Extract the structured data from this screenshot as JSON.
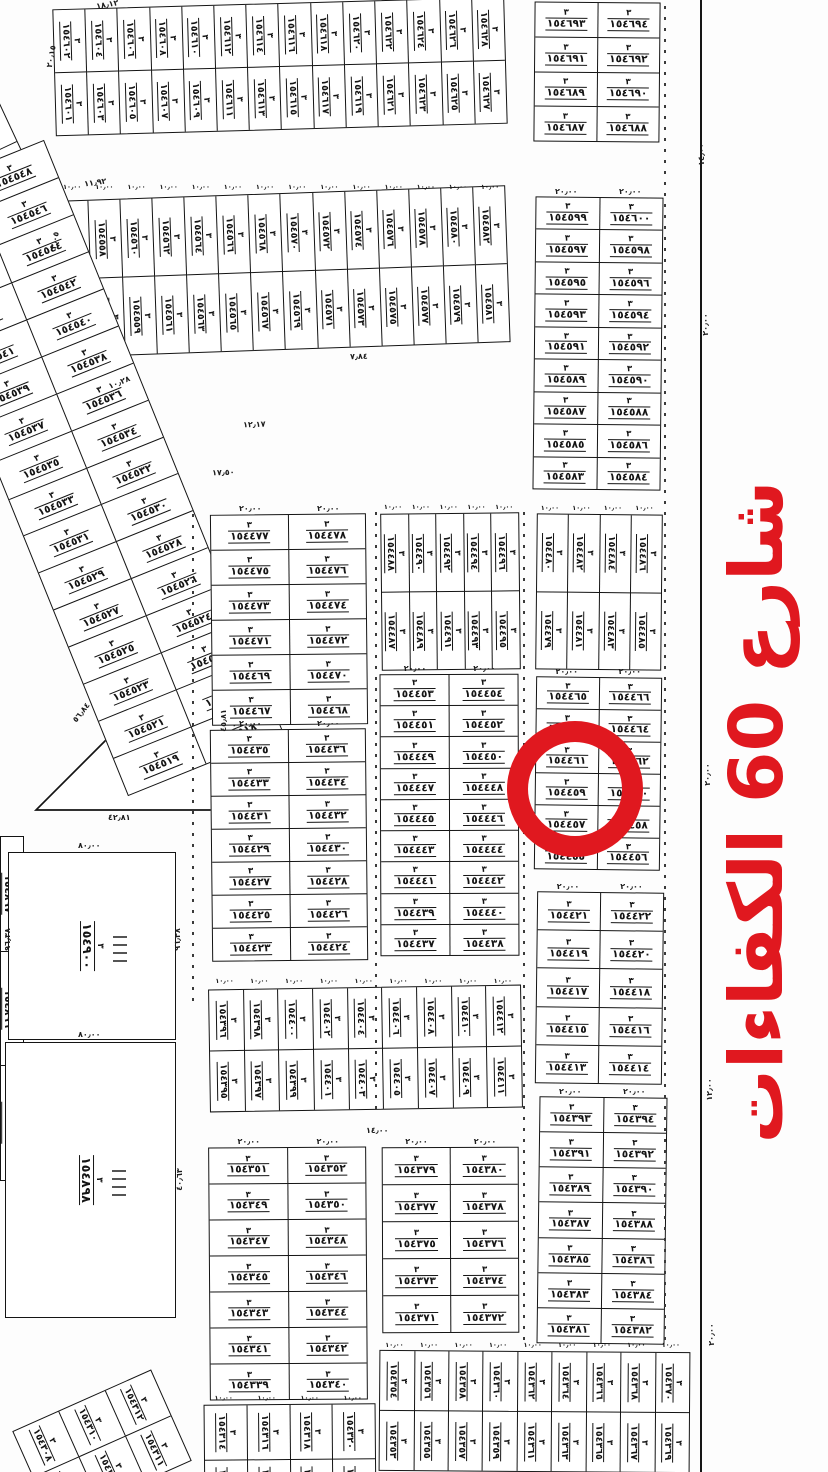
{
  "colors": {
    "red": "#e0181f",
    "ink": "#141414"
  },
  "street_label": {
    "text": "شارع 60 الكفاءات"
  },
  "highlight_circle": {
    "plot": "١٥٤٤٦٠"
  },
  "block_no": "٣",
  "triangle": {
    "label": "١٥٤٩٠١"
  },
  "plots_large": [
    {
      "id": "p154900",
      "label": "١٥٤٩٠٠",
      "x": 8,
      "y": 852,
      "w": 168,
      "h": 188
    },
    {
      "id": "p154898",
      "label": "١٥٤٨٩٨",
      "x": 5,
      "y": 1042,
      "w": 171,
      "h": 276
    }
  ],
  "ticks": [
    {
      "x": 664,
      "y": 6,
      "h": 1340,
      "solid": false
    },
    {
      "x": 700,
      "y": 0,
      "h": 1472,
      "solid": true
    },
    {
      "x": 375,
      "y": 512,
      "h": 598,
      "solid": false
    },
    {
      "x": 523,
      "y": 512,
      "h": 835,
      "solid": false
    },
    {
      "x": 192,
      "y": 514,
      "h": 490,
      "solid": false
    }
  ],
  "dims": [
    {
      "t": "١٨٫١٢",
      "x": 96,
      "y": 0,
      "r": -10
    },
    {
      "t": "٢٠٫١٥",
      "x": 40,
      "y": 52,
      "r": -80
    },
    {
      "t": "١١٫٩٢",
      "x": 84,
      "y": 178,
      "r": -8
    },
    {
      "t": "٣٫٠٥",
      "x": 46,
      "y": 236,
      "r": -80
    },
    {
      "t": "١٠٫٢٨",
      "x": 108,
      "y": 378,
      "r": -22
    },
    {
      "t": "١٢٫١٧",
      "x": 243,
      "y": 420,
      "r": -2
    },
    {
      "t": "١٧٫٥٠",
      "x": 212,
      "y": 468,
      "r": -2
    },
    {
      "t": "٧٫٨٤",
      "x": 350,
      "y": 352,
      "r": -2
    },
    {
      "t": "٤٢٫٨١",
      "x": 108,
      "y": 813,
      "r": 0
    },
    {
      "t": "٤٥٫٨١",
      "x": 212,
      "y": 716,
      "r": -90
    },
    {
      "t": "٥٦٫٨٤",
      "x": 70,
      "y": 708,
      "r": -52
    },
    {
      "t": "٨٠٫٠٠",
      "x": 78,
      "y": 841,
      "r": 0
    },
    {
      "t": "٨٠٫٠٠",
      "x": 78,
      "y": 1030,
      "r": 0
    },
    {
      "t": "٩٦٫٣٨",
      "x": -4,
      "y": 935,
      "r": -90
    },
    {
      "t": "٩٦٫٣٨",
      "x": 166,
      "y": 935,
      "r": -90
    },
    {
      "t": "٤٠٫٦٣",
      "x": 168,
      "y": 1175,
      "r": -90
    },
    {
      "t": "١٤٫٠٠",
      "x": 366,
      "y": 1126,
      "r": 0
    },
    {
      "t": "١٤٫٠٠",
      "x": 690,
      "y": 150,
      "r": -90
    },
    {
      "t": "٢٠٫٠٠",
      "x": 694,
      "y": 320,
      "r": -90
    },
    {
      "t": "٢٠٫٠٠",
      "x": 696,
      "y": 770,
      "r": -90
    },
    {
      "t": "١٢٫٠٠",
      "x": 698,
      "y": 1085,
      "r": -90
    },
    {
      "t": "٢٠٫٠٠",
      "x": 700,
      "y": 1330,
      "r": -90
    }
  ],
  "blocks": [
    {
      "id": "t1",
      "type": "v",
      "x": 54,
      "y": 3,
      "w": 452,
      "h": 127,
      "rot": -1.6,
      "dim": "١٠٫٠٠",
      "cols": [
        [
          "١٥٤٦٢٨",
          "١٥٤٦٢٧"
        ],
        [
          "١٥٤٦٢٦",
          "١٥٤٦٢٥"
        ],
        [
          "١٥٤٦٢٤",
          "١٥٤٦٢٣"
        ],
        [
          "١٥٤٦٢٢",
          "١٥٤٦٢١"
        ],
        [
          "١٥٤٦٢٠",
          "١٥٤٦١٩"
        ],
        [
          "١٥٤٦١٨",
          "١٥٤٦١٧"
        ],
        [
          "١٥٤٦١٦",
          "١٥٤٦١٥"
        ],
        [
          "١٥٤٦١٤",
          "١٥٤٦١٣"
        ],
        [
          "١٥٤٦١٢",
          "١٥٤٦١١"
        ],
        [
          "١٥٤٦١٠",
          "١٥٤٦٠٩"
        ],
        [
          "١٥٤٦٠٨",
          "١٥٤٦٠٧"
        ],
        [
          "١٥٤٦٠٦",
          "١٥٤٦٠٥"
        ],
        [
          "١٥٤٦٠٤",
          "١٥٤٦٠٣"
        ],
        [
          "١٥٤٦٠٢",
          "١٥٤٦٠١"
        ]
      ]
    },
    {
      "id": "t2",
      "type": "v",
      "x": 58,
      "y": 193,
      "w": 450,
      "h": 157,
      "rot": -2,
      "dim": "١٠٫٠٠",
      "cols": [
        [
          "١٥٤٥٨٢",
          "١٥٤٥٨١"
        ],
        [
          "١٥٤٥٨٠",
          "١٥٤٥٧٩"
        ],
        [
          "١٥٤٥٧٨",
          "١٥٤٥٧٧"
        ],
        [
          "١٥٤٥٧٦",
          "١٥٤٥٧٥"
        ],
        [
          "١٥٤٥٧٤",
          "١٥٤٥٧٣"
        ],
        [
          "١٥٤٥٧٢",
          "١٥٤٥٧١"
        ],
        [
          "١٥٤٥٧٠",
          "١٥٤٥٦٩"
        ],
        [
          "١٥٤٥٦٨",
          "١٥٤٥٦٧"
        ],
        [
          "١٥٤٥٦٦",
          "١٥٤٥٦٥"
        ],
        [
          "١٥٤٥٦٤",
          "١٥٤٥٦٣"
        ],
        [
          "١٥٤٥٦٢",
          "١٥٤٥٦١"
        ],
        [
          "١٥٤٥٦٠",
          "١٥٤٥٥٩"
        ],
        [
          "١٥٤٥٥٨",
          "١٥٤٥٥٧"
        ],
        [
          "١٥٤٥٥٦",
          "١٥٤٥٥٥"
        ]
      ]
    },
    {
      "id": "edge-tl",
      "type": "grid",
      "x": -38,
      "y": -8,
      "w": 82,
      "h": 430,
      "rot": -25,
      "rows": [
        [
          "١٥٤٦٤٤"
        ],
        [
          "١٥٤٦٤٢"
        ],
        [
          "١٥٤٦٤٠"
        ],
        [
          "١٥٤٦٣٨"
        ],
        [
          "١٥٤٦٣٦"
        ],
        [
          "١٥٤٦٣٤"
        ],
        [
          "١٥٤٦٣٢"
        ],
        [
          "١٥٤٦٣٠"
        ]
      ]
    },
    {
      "id": "diag",
      "type": "grid",
      "x": 2,
      "y": 148,
      "w": 168,
      "h": 640,
      "rot": -22,
      "rows": [
        [
          "١٥٤٥٤٨",
          "١٥٤٥٤٩"
        ],
        [
          "١٥٤٥٤٦",
          "١٥٤٥٤٧"
        ],
        [
          "١٥٤٥٤٤",
          "١٥٤٥٤٥"
        ],
        [
          "١٥٤٥٤٢",
          "١٥٤٥٤٣"
        ],
        [
          "١٥٤٥٤٠",
          "١٥٤٥٤١"
        ],
        [
          "١٥٤٥٣٨",
          "١٥٤٥٣٩"
        ],
        [
          "١٥٤٥٣٦",
          "١٥٤٥٣٧"
        ],
        [
          "١٥٤٥٣٤",
          "١٥٤٥٣٥"
        ],
        [
          "١٥٤٥٣٢",
          "١٥٤٥٣٣"
        ],
        [
          "١٥٤٥٣٠",
          "١٥٤٥٣١"
        ],
        [
          "١٥٤٥٢٨",
          "١٥٤٥٢٩"
        ],
        [
          "١٥٤٥٢٦",
          "١٥٤٥٢٧"
        ],
        [
          "١٥٤٥٢٤",
          "١٥٤٥٢٥"
        ],
        [
          "١٥٤٥٢٢",
          "١٥٤٥٢٣"
        ],
        [
          "١٥٤٥٢٠",
          "١٥٤٥٢١"
        ],
        [
          "١٥٤٥١٨",
          "١٥٤٥١٩"
        ]
      ]
    },
    {
      "id": "r1",
      "type": "grid",
      "x": 534,
      "y": 2,
      "w": 126,
      "h": 140,
      "rot": 0.5,
      "dim": "٢٠٫٠٠",
      "rows": [
        [
          "١٥٤٦٩٤",
          "١٥٤٦٩٣"
        ],
        [
          "١٥٤٦٩٢",
          "١٥٤٦٩١"
        ],
        [
          "١٥٤٦٩٠",
          "١٥٤٦٨٩"
        ],
        [
          "١٥٤٦٨٨",
          "١٥٤٦٨٧"
        ]
      ]
    },
    {
      "id": "r2",
      "type": "grid",
      "x": 534,
      "y": 197,
      "w": 128,
      "h": 293,
      "rot": 0.6,
      "dim": "٢٠٫٠٠",
      "rows": [
        [
          "١٥٤٦٠٠",
          "١٥٤٥٩٩"
        ],
        [
          "١٥٤٥٩٨",
          "١٥٤٥٩٧"
        ],
        [
          "١٥٤٥٩٦",
          "١٥٤٥٩٥"
        ],
        [
          "١٥٤٥٩٤",
          "١٥٤٥٩٣"
        ],
        [
          "١٥٤٥٩٢",
          "١٥٤٥٩١"
        ],
        [
          "١٥٤٥٩٠",
          "١٥٤٥٨٩"
        ],
        [
          "١٥٤٥٨٨",
          "١٥٤٥٨٧"
        ],
        [
          "١٥٤٥٨٦",
          "١٥٤٥٨٥"
        ],
        [
          "١٥٤٥٨٤",
          "١٥٤٥٨٣"
        ]
      ]
    },
    {
      "id": "rb",
      "type": "v",
      "x": 536,
      "y": 514,
      "w": 126,
      "h": 156,
      "rot": 0.6,
      "dim": "١٠٫٠٠",
      "cols": [
        [
          "١٥٤٤٨٦",
          "١٥٤٤٨٥"
        ],
        [
          "١٥٤٤٨٤",
          "١٥٤٤٨٣"
        ],
        [
          "١٥٤٤٨٢",
          "١٥٤٤٨١"
        ],
        [
          "١٥٤٤٨٠",
          "١٥٤٤٧٩"
        ]
      ]
    },
    {
      "id": "mb",
      "type": "v",
      "x": 381,
      "y": 513,
      "w": 139,
      "h": 157,
      "rot": -0.6,
      "dim": "١٠٫٠٠",
      "cols": [
        [
          "١٥٤٤٩٦",
          "١٥٤٤٩٥"
        ],
        [
          "١٥٤٤٩٤",
          "١٥٤٤٩٣"
        ],
        [
          "١٥٤٤٩٢",
          "١٥٤٤٩١"
        ],
        [
          "١٥٤٤٩٠",
          "١٥٤٤٨٩"
        ],
        [
          "١٥٤٤٨٨",
          "١٥٤٤٨٧"
        ]
      ]
    },
    {
      "id": "l1",
      "type": "grid",
      "x": 211,
      "y": 514,
      "w": 156,
      "h": 211,
      "rot": -0.6,
      "dim": "٢٠٫٠٠",
      "rows": [
        [
          "١٥٤٤٧٨",
          "١٥٤٤٧٧"
        ],
        [
          "١٥٤٤٧٦",
          "١٥٤٤٧٥"
        ],
        [
          "١٥٤٤٧٤",
          "١٥٤٤٧٣"
        ],
        [
          "١٥٤٤٧٢",
          "١٥٤٤٧١"
        ],
        [
          "١٥٤٤٧٠",
          "١٥٤٤٦٩"
        ],
        [
          "١٥٤٤٦٨",
          "١٥٤٤٦٧"
        ]
      ]
    },
    {
      "id": "l2",
      "type": "grid",
      "x": 211,
      "y": 729,
      "w": 156,
      "h": 232,
      "rot": -0.6,
      "dim": "٢٠٫٠٠",
      "rows": [
        [
          "١٥٤٤٣٦",
          "١٥٤٤٣٥"
        ],
        [
          "١٥٤٤٣٤",
          "١٥٤٤٣٣"
        ],
        [
          "١٥٤٤٣٢",
          "١٥٤٤٣١"
        ],
        [
          "١٥٤٤٣٠",
          "١٥٤٤٢٩"
        ],
        [
          "١٥٤٤٢٨",
          "١٥٤٤٢٧"
        ],
        [
          "١٥٤٤٢٦",
          "١٥٤٤٢٥"
        ],
        [
          "١٥٤٤٢٤",
          "١٥٤٤٢٣"
        ]
      ]
    },
    {
      "id": "m1",
      "type": "grid",
      "x": 380,
      "y": 674,
      "w": 139,
      "h": 282,
      "rot": -0.2,
      "dim": "٢٠٫٠٠",
      "rows": [
        [
          "١٥٤٤٥٤",
          "١٥٤٤٥٣"
        ],
        [
          "١٥٤٤٥٢",
          "١٥٤٤٥١"
        ],
        [
          "١٥٤٤٥٠",
          "١٥٤٤٤٩"
        ],
        [
          "١٥٤٤٤٨",
          "١٥٤٤٤٧"
        ],
        [
          "١٥٤٤٤٦",
          "١٥٤٤٤٥"
        ],
        [
          "١٥٤٤٤٤",
          "١٥٤٤٤٣"
        ],
        [
          "١٥٤٤٤٢",
          "١٥٤٤٤١"
        ],
        [
          "١٥٤٤٤٠",
          "١٥٤٤٣٩"
        ],
        [
          "١٥٤٤٣٨",
          "١٥٤٤٣٧"
        ]
      ]
    },
    {
      "id": "r3-circle-block",
      "type": "grid",
      "x": 535,
      "y": 677,
      "w": 126,
      "h": 193,
      "rot": 0.7,
      "dim": "٢٠٫٠٠",
      "rows": [
        [
          "١٥٤٤٦٦",
          "١٥٤٤٦٥"
        ],
        [
          "١٥٤٤٦٤",
          "١٥٤٤٦٣"
        ],
        [
          "١٥٤٤٦٢",
          "١٥٤٤٦١"
        ],
        [
          "١٥٤٤٦٠",
          "١٥٤٤٥٩"
        ],
        [
          "١٥٤٤٥٨",
          "١٥٤٤٥٧"
        ],
        [
          "١٥٤٤٥٦",
          "١٥٤٤٥٥"
        ]
      ]
    },
    {
      "id": "r4",
      "type": "grid",
      "x": 536,
      "y": 892,
      "w": 127,
      "h": 192,
      "rot": 0.7,
      "dim": "٢٠٫٠٠",
      "rows": [
        [
          "١٥٤٤٢٢",
          "١٥٤٤٢١"
        ],
        [
          "١٥٤٤٢٠",
          "١٥٤٤١٩"
        ],
        [
          "١٥٤٤١٨",
          "١٥٤٤١٧"
        ],
        [
          "١٥٤٤١٦",
          "١٥٤٤١٥"
        ],
        [
          "١٥٤٤١٤",
          "١٥٤٤١٣"
        ]
      ]
    },
    {
      "id": "mid2",
      "type": "v",
      "x": 209,
      "y": 987,
      "w": 313,
      "h": 123,
      "rot": -0.9,
      "dim": "١٠٫٠٠",
      "cols": [
        [
          "١٥٤٤١٢",
          "١٥٤٤١١"
        ],
        [
          "١٥٤٤١٠",
          "١٥٤٤٠٩"
        ],
        [
          "١٥٤٤٠٨",
          "١٥٤٤٠٧"
        ],
        [
          "١٥٤٤٠٦",
          "١٥٤٤٠٥"
        ],
        [
          "١٥٤٤٠٤",
          "١٥٤٤٠٣"
        ],
        [
          "١٥٤٤٠٢",
          "١٥٤٤٠١"
        ],
        [
          "١٥٤٤٠٠",
          "١٥٤٣٩٩"
        ],
        [
          "١٥٤٣٩٨",
          "١٥٤٣٩٧"
        ],
        [
          "١٥٤٣٩٦",
          "١٥٤٣٩٥"
        ]
      ]
    },
    {
      "id": "r5",
      "type": "grid",
      "x": 538,
      "y": 1097,
      "w": 128,
      "h": 247,
      "rot": 0.7,
      "dim": "٢٠٫٠٠",
      "rows": [
        [
          "١٥٤٣٩٤",
          "١٥٤٣٩٣"
        ],
        [
          "١٥٤٣٩٢",
          "١٥٤٣٩١"
        ],
        [
          "١٥٤٣٩٠",
          "١٥٤٣٨٩"
        ],
        [
          "١٥٤٣٨٨",
          "١٥٤٣٨٧"
        ],
        [
          "١٥٤٣٨٦",
          "١٥٤٣٨٥"
        ],
        [
          "١٥٤٣٨٤",
          "١٥٤٣٨٣"
        ],
        [
          "١٥٤٣٨٢",
          "١٥٤٣٨١"
        ]
      ]
    },
    {
      "id": "m2",
      "type": "grid",
      "x": 382,
      "y": 1147,
      "w": 137,
      "h": 186,
      "rot": -0.2,
      "dim": "٢٠٫٠٠",
      "rows": [
        [
          "١٥٤٣٨٠",
          "١٥٤٣٧٩"
        ],
        [
          "١٥٤٣٧٨",
          "١٥٤٣٧٧"
        ],
        [
          "١٥٤٣٧٦",
          "١٥٤٣٧٥"
        ],
        [
          "١٥٤٣٧٤",
          "١٥٤٣٧٣"
        ],
        [
          "١٥٤٣٧٢",
          "١٥٤٣٧١"
        ]
      ]
    },
    {
      "id": "l3",
      "type": "grid",
      "x": 209,
      "y": 1147,
      "w": 158,
      "h": 253,
      "rot": -0.4,
      "dim": "٢٠٫٠٠",
      "rows": [
        [
          "١٥٤٣٥٢",
          "١٥٤٣٥١"
        ],
        [
          "١٥٤٣٥٠",
          "١٥٤٣٤٩"
        ],
        [
          "١٥٤٣٤٨",
          "١٥٤٣٤٧"
        ],
        [
          "١٥٤٣٤٦",
          "١٥٤٣٤٥"
        ],
        [
          "١٥٤٣٤٤",
          "١٥٤٣٤٣"
        ],
        [
          "١٥٤٣٤٢",
          "١٥٤٣٤١"
        ],
        [
          "١٥٤٣٤٠",
          "١٥٤٣٣٩"
        ]
      ]
    },
    {
      "id": "bband-right",
      "type": "v",
      "x": 379,
      "y": 1351,
      "w": 311,
      "h": 121,
      "rot": 0.4,
      "dim": "١٠٫٠٠",
      "cols": [
        [
          "١٥٤٣٧٠",
          "١٥٤٣٦٩"
        ],
        [
          "١٥٤٣٦٨",
          "١٥٤٣٦٧"
        ],
        [
          "١٥٤٣٦٦",
          "١٥٤٣٦٥"
        ],
        [
          "١٥٤٣٦٤",
          "١٥٤٣٦٣"
        ],
        [
          "١٥٤٣٦٢",
          "١٥٤٣٦١"
        ],
        [
          "١٥٤٣٦٠",
          "١٥٤٣٥٩"
        ],
        [
          "١٥٤٣٥٨",
          "١٥٤٣٥٧"
        ],
        [
          "١٥٤٣٥٦",
          "١٥٤٣٥٥"
        ],
        [
          "١٥٤٣٥٤",
          "١٥٤٣٥٣"
        ]
      ]
    },
    {
      "id": "bband-left",
      "type": "v",
      "x": 204,
      "y": 1404,
      "w": 172,
      "h": 110,
      "rot": -0.5,
      "dim": "١٠٫٠٠",
      "cols": [
        [
          "١٥٤٣٢٠",
          "١٥٤٣١٩"
        ],
        [
          "١٥٤٣١٨",
          "١٥٤٣١٧"
        ],
        [
          "١٥٤٣١٦",
          "١٥٤٣١٥"
        ],
        [
          "١٥٤٣١٤",
          "١٥٤٣١٣"
        ]
      ]
    },
    {
      "id": "corner-bl",
      "type": "v",
      "x": 26,
      "y": 1396,
      "w": 152,
      "h": 100,
      "rot": -24,
      "cols": [
        [
          "١٥٤٣١٢",
          "١٥٤٣١١"
        ],
        [
          "١٥٤٣١٠",
          "١٥٤٣٠٩"
        ],
        [
          "١٥٤٣٠٨",
          "١٥٤٣٠٧"
        ]
      ]
    },
    {
      "id": "edge-bl",
      "type": "grid",
      "x": 0,
      "y": 836,
      "w": 24,
      "h": 345,
      "rot": 0,
      "cellrot": true,
      "rows": [
        [
          "١٥٤٨٩٧"
        ],
        [
          "١٥٤٨٩٦"
        ],
        [
          "١٥٤٨٩٥"
        ]
      ]
    }
  ]
}
